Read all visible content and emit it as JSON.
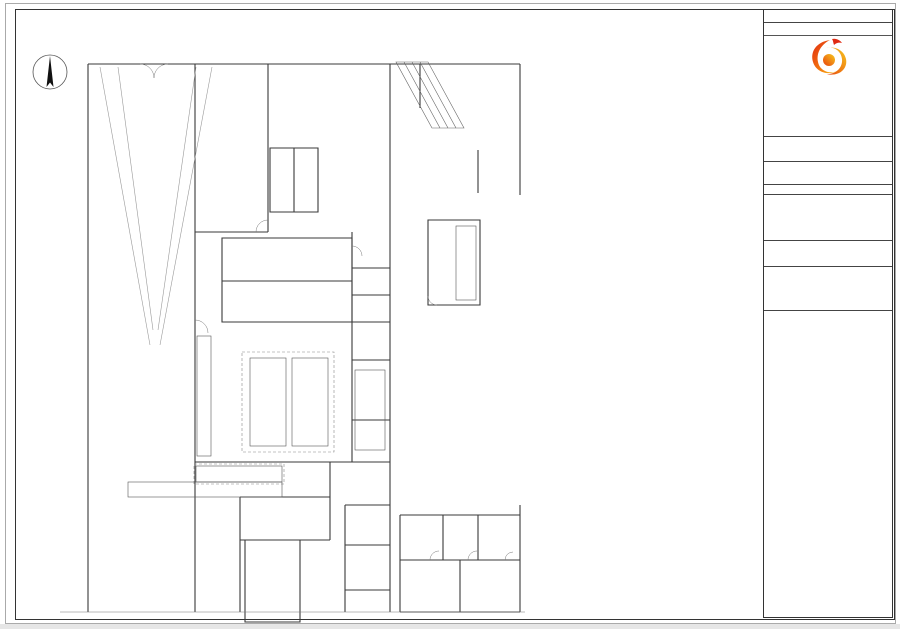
{
  "compass": {
    "label": "北"
  },
  "grid": {
    "top_bubbles": [
      "10-1",
      "10-2",
      "10-3",
      "10-4"
    ],
    "top_bubble_x": [
      98,
      223,
      348,
      470
    ],
    "top_dims": [
      {
        "t": "2300",
        "x": 84
      },
      {
        "t": "7800",
        "x": 160
      },
      {
        "t": "7800",
        "x": 286
      },
      {
        "t": "7500",
        "x": 408
      }
    ],
    "left_dims": [
      {
        "t": "6900",
        "y": 105
      },
      {
        "t": "8400",
        "y": 232
      },
      {
        "t": "9000",
        "y": 390
      },
      {
        "t": "5500",
        "y": 530
      }
    ]
  },
  "plan": {
    "labels": [
      {
        "t": "后勤出入口",
        "x": 147,
        "y": 61,
        "s": 3.5
      },
      {
        "t": "车道上空",
        "x": 161,
        "y": 272,
        "s": 9
      },
      {
        "t": "西厨办公室",
        "x": 231,
        "y": 241,
        "s": 4
      },
      {
        "t": "冷藏库",
        "x": 262,
        "y": 259,
        "s": 4.5
      },
      {
        "t": "冷冻库",
        "x": 262,
        "y": 296,
        "s": 4.5
      },
      {
        "t": "西餐厨房",
        "x": 261,
        "y": 343,
        "s": 4.5
      },
      {
        "t": "餐饮办公室",
        "x": 371,
        "y": 252,
        "s": 3.2
      },
      {
        "t": "酒水库",
        "x": 369,
        "y": 287,
        "s": 3.2
      },
      {
        "t": "调料库",
        "x": 369,
        "y": 316,
        "s": 3.2
      },
      {
        "t": "备餐间",
        "x": 369,
        "y": 392,
        "s": 3.2
      },
      {
        "t": "大堂吧",
        "x": 509,
        "y": 182,
        "s": 7.5
      },
      {
        "t": "大堂吧制作间",
        "x": 447,
        "y": 279,
        "s": 3
      },
      {
        "t": "大堂",
        "x": 506,
        "y": 313,
        "s": 8
      },
      {
        "t": "吧台",
        "x": 213,
        "y": 459,
        "s": 3.2
      },
      {
        "t": "全日制餐厅",
        "x": 128,
        "y": 578,
        "s": 5.5
      },
      {
        "t": "自助餐台",
        "x": 204,
        "y": 588,
        "s": 3.5
      },
      {
        "t": "水井",
        "x": 366,
        "y": 530,
        "s": 3
      },
      {
        "t": "强电间",
        "x": 361,
        "y": 568,
        "s": 3
      },
      {
        "t": "弱电间",
        "x": 361,
        "y": 610,
        "s": 3
      },
      {
        "t": "保洁间",
        "x": 420,
        "y": 588,
        "s": 3
      },
      {
        "t": "女卫生间1",
        "x": 409,
        "y": 535,
        "s": 3
      },
      {
        "t": "女卫生间2",
        "x": 453,
        "y": 535,
        "s": 3
      },
      {
        "t": "女卫生间3",
        "x": 495,
        "y": 535,
        "s": 3
      },
      {
        "t": "无障碍卫生间",
        "x": 504,
        "y": 578,
        "s": 2.8
      },
      {
        "t": "男卫生间",
        "x": 474,
        "y": 602,
        "s": 3
      }
    ]
  },
  "tables": {
    "headers": [
      "序号",
      "名称",
      "规格型号",
      "数量",
      "单位"
    ],
    "left_rows": [
      {
        "s": "冷藏、冷冻库"
      },
      {
        "n": "BA01",
        "m": "四层货架",
        "g": "1200×600×1800",
        "q": "12",
        "u": "台"
      },
      {
        "n": "BA02a",
        "m": "冷冻库体",
        "g": "2500×2500×2500",
        "q": "60",
        "u": "m³"
      },
      {
        "n": "BA02b",
        "m": "冷冻库门",
        "g": "",
        "q": "1",
        "u": "个"
      },
      {
        "n": "BA02c",
        "m": "冷冻制冷机组",
        "g": "",
        "q": "1",
        "u": "组"
      },
      {
        "n": "BA02d",
        "m": "室内冷风机",
        "g": "",
        "q": "1",
        "u": "台"
      },
      {
        "n": "BA03a",
        "m": "冷藏库体",
        "g": "2500×2300×2500",
        "q": "61.5",
        "u": "m³"
      },
      {
        "n": "BA03b",
        "m": "冷藏库门",
        "g": "",
        "q": "1",
        "u": "个"
      },
      {
        "n": "BA03c",
        "m": "冷藏制冷机组",
        "g": "",
        "q": "1",
        "u": "组"
      },
      {
        "n": "BA03d",
        "m": "室内冷风机",
        "g": "",
        "q": "1",
        "u": "台"
      },
      {
        "n": "BA04",
        "m": "四层货架",
        "g": "1500×600×1800",
        "q": "4",
        "u": "台"
      },
      {
        "s": "干货库"
      },
      {
        "n": "BB01",
        "m": "四层货架",
        "g": "1500×600×1800",
        "q": "2",
        "u": "台"
      },
      {
        "n": "BB02",
        "m": "四层货架",
        "g": "1200×600×1800",
        "q": "1",
        "u": "台"
      },
      {
        "s": "蛋糕展示区"
      },
      {
        "n": "BC01",
        "m": "三层蛋糕展示柜",
        "g": "1500×600×1800",
        "q": "1",
        "u": "台"
      },
      {
        "s": "酒水库"
      },
      {
        "n": "BE01",
        "m": "四层货架",
        "g": "1500×600×1800",
        "q": "2",
        "u": "台"
      },
      {
        "n": "BE02",
        "m": "四层货架",
        "g": "1200×600×1800",
        "q": "1",
        "u": "台"
      },
      {
        "s": "粗加工间、冷菜间"
      },
      {
        "n": "BF01",
        "m": "洗手池",
        "g": "500×500×800",
        "q": "1",
        "u": "台"
      },
      {
        "n": "BF01a",
        "m": "感应水龙头",
        "g": "",
        "q": "1",
        "u": "个"
      },
      {
        "n": "BF02",
        "m": "碗柜",
        "g": "1200×600×1800",
        "q": "1",
        "u": "台"
      },
      {
        "n": "BF03",
        "m": "双星洗池",
        "g": "1200×700×800",
        "q": "1",
        "u": "台"
      },
      {
        "n": "BF03a",
        "m": "泡水龙头",
        "g": "",
        "q": "2",
        "u": "个"
      },
      {
        "n": "BF03b",
        "m": "隔渣笼",
        "g": "300×300×300",
        "q": "1",
        "u": "个"
      },
      {
        "n": "BF03c",
        "m": "挂墙单层架",
        "g": "1200×300",
        "q": "1",
        "u": "台"
      },
      {
        "n": "BF04",
        "m": "四门高身雪柜",
        "g": "1220×760×1955",
        "q": "1",
        "u": "台"
      },
      {
        "n": "BF05",
        "m": "单星解冻池",
        "g": "1800×750×800",
        "q": "1",
        "u": "台"
      },
      {
        "n": "BF06",
        "m": "落地层架",
        "g": "1800×750×400",
        "q": "3",
        "u": "台"
      },
      {
        "n": "BF07",
        "m": "双门平台雪柜",
        "g": "1800×750×800",
        "q": "1",
        "u": "台"
      },
      {
        "n": "BF08",
        "m": "单层调理架",
        "g": "1100×750×800",
        "q": "1",
        "u": "台"
      },
      {
        "n": "BF09",
        "m": "两头矮汤炉",
        "g": "",
        "q": "1",
        "u": "台"
      },
      {
        "s": "洗碗间"
      },
      {
        "n": "BG01",
        "m": "碗架",
        "g": "1200×500×1800",
        "q": "3",
        "u": "台"
      },
      {
        "n": "BG02",
        "m": "双层工作台",
        "g": "1800×760×800",
        "q": "1",
        "u": "台"
      },
      {
        "n": "BG03",
        "m": "高温消毒柜",
        "g": "",
        "q": "1",
        "u": "台"
      },
      {
        "n": "BG04",
        "m": "洁碟台",
        "g": "1500×760×800",
        "q": "1",
        "u": "台"
      },
      {
        "n": "BG05",
        "m": "排气罩",
        "g": "1600×1000",
        "q": "1.1",
        "u": "㎡"
      },
      {
        "n": "BG06",
        "m": "洗碗机",
        "g": "",
        "q": "1",
        "u": "台"
      },
      {
        "n": "BG06a",
        "m": "洗碗机用软水机",
        "g": "",
        "q": "1",
        "u": "台"
      },
      {
        "n": "BG07",
        "m": "水压花洒",
        "g": "",
        "q": "1",
        "u": "台"
      },
      {
        "n": "BG08",
        "m": "双星污碟台",
        "g": "1800×750×800",
        "q": "1",
        "u": "台"
      },
      {
        "n": "BG08a",
        "m": "隔渣笼",
        "g": "300×300×300",
        "q": "1",
        "u": "个"
      },
      {
        "n": "BG08b",
        "m": "泡水龙头",
        "g": "",
        "q": "1",
        "u": "个"
      },
      {
        "n": "BG09",
        "m": "残食台",
        "g": "1200×750×800",
        "q": "1",
        "u": "台"
      },
      {
        "n": "BG10",
        "m": "洗碗龙头",
        "g": "",
        "q": "1",
        "u": "台"
      },
      {
        "s": "备餐间"
      },
      {
        "n": "BH01",
        "m": "制冰机",
        "g": "300KG",
        "q": "1",
        "u": "台"
      },
      {
        "n": "BH01a",
        "m": "制冰机用滤水器",
        "g": "",
        "q": "1",
        "u": "台"
      },
      {
        "n": "BH02",
        "m": "制冰机",
        "g": "100KG",
        "q": "1",
        "u": "台"
      },
      {
        "n": "BH02a",
        "m": "制冰机用滤水器",
        "g": "",
        "q": "1",
        "u": "台"
      },
      {
        "n": "BH03",
        "m": "单星盆台连双层吊架",
        "g": "1500×750×800",
        "q": "1",
        "u": "台"
      },
      {
        "n": "BH03a",
        "m": "泡水龙头",
        "g": "",
        "q": "1",
        "u": "个"
      },
      {
        "n": "BH03b",
        "m": "隔渣笼",
        "g": "300×300×300",
        "q": "1",
        "u": "个"
      },
      {
        "n": "BH04",
        "m": "台式开水器",
        "g": "9KW",
        "q": "1",
        "u": "台"
      },
      {
        "n": "BH04a",
        "m": "开水器用滤水器",
        "g": "",
        "q": "1",
        "u": "台"
      },
      {
        "n": "BH05",
        "m": "单层调理架",
        "g": "1800×750×800",
        "q": "1",
        "u": "台"
      },
      {
        "n": "BH06",
        "m": "落地层架",
        "g": "1800×350×400",
        "q": "1",
        "u": "台"
      },
      {
        "s": "西餐厨房"
      },
      {
        "n": "BI01",
        "m": "四层货架",
        "g": "900×760×1800",
        "q": "1",
        "u": "台"
      },
      {
        "n": "BI02",
        "m": "四门高身雪柜",
        "g": "1220×760×1955",
        "q": "2",
        "u": "台"
      },
      {
        "n": "BI03",
        "m": "单星盆台",
        "g": "600×760×800",
        "q": "2",
        "u": "台"
      },
      {
        "n": "BI03a",
        "m": "泡水龙头",
        "g": "",
        "q": "2",
        "u": "个"
      },
      {
        "n": "BI03b",
        "m": "隔渣笼",
        "g": "300×300×300",
        "q": "2",
        "u": "个"
      },
      {
        "n": "BI04",
        "m": "双门平台雪柜",
        "g": "1800×750×800",
        "q": "1",
        "u": "台"
      },
      {
        "n": "BI04a",
        "m": "底置制冷机组",
        "g": "",
        "q": "4",
        "u": "台"
      }
    ],
    "right_rows": [
      {
        "n": "BI05",
        "m": "双门恒温平台雪柜",
        "g": "1800×750×800",
        "q": "2",
        "u": "台"
      },
      {
        "n": "BI06",
        "m": "洗地龙头",
        "g": "",
        "q": "1",
        "u": "台"
      },
      {
        "n": "BI07",
        "m": "四层烤盘架",
        "g": "1500×750×800",
        "q": "1",
        "u": "台"
      },
      {
        "n": "BI08",
        "m": "柜式运水烟罩机",
        "g": "1800×750×800",
        "q": "1",
        "u": "台"
      },
      {
        "n": "BI09",
        "m": "双层工作台",
        "g": "",
        "q": "1",
        "u": "台"
      },
      {
        "n": "BI10",
        "m": "燃气平头炉连底柜",
        "g": "700×775×850",
        "q": "1",
        "u": "台"
      },
      {
        "n": "BI11",
        "m": "吊柜",
        "g": "定制",
        "q": "2",
        "u": "台"
      },
      {
        "n": "BI12",
        "m": "电磁大炉",
        "g": "",
        "q": "1",
        "u": "台"
      },
      {
        "n": "BI13",
        "m": "单层调理架",
        "g": "2500×750×800",
        "q": "1",
        "u": "台"
      },
      {
        "n": "BI14",
        "m": "双缸电炸炉",
        "g": "700×775×850",
        "q": "1",
        "u": "台"
      },
      {
        "n": "BI15",
        "m": "吊柜",
        "g": "600×750×600",
        "q": "1",
        "u": "台"
      },
      {
        "n": "BI16",
        "m": "单头矮汤炉",
        "g": "600×775×850",
        "q": "1",
        "u": "台"
      },
      {
        "n": "BI17",
        "m": "吊柜",
        "g": "600×750×600",
        "q": "1",
        "u": "台"
      },
      {
        "n": "BI18",
        "m": "燃气扒炉连柜",
        "g": "700×775×850",
        "q": "1",
        "u": "台"
      },
      {
        "n": "BI19",
        "m": "单星水池",
        "g": "600×750×800",
        "q": "1",
        "u": "台"
      },
      {
        "n": "BI19a",
        "m": "泡水龙头",
        "g": "",
        "q": "1",
        "u": "个"
      },
      {
        "n": "BI19b",
        "m": "隔渣笼",
        "g": "300×300×300",
        "q": "1",
        "u": "个"
      },
      {
        "n": "BI20",
        "m": "燃气六头煲仔炉连柜",
        "g": "1000×775×850",
        "q": "1",
        "u": "台"
      },
      {
        "n": "BI21",
        "m": "万能蒸柜",
        "g": "10盘",
        "q": "1",
        "u": "台"
      },
      {
        "n": "BI21a",
        "m": "万能蒸柜用软水机",
        "g": "",
        "q": "1",
        "u": "台"
      },
      {
        "n": "BI22",
        "m": "岛式运水烟罩",
        "g": "4500×1200×600",
        "q": "9.9",
        "u": "平米"
      },
      {
        "n": "BI22a",
        "m": "运水烟罩装饰包板",
        "g": "",
        "q": "13.4",
        "u": "米"
      },
      {
        "n": "BI23",
        "m": "搁板架",
        "g": "1200×600×1800",
        "q": "1",
        "u": "台"
      },
      {
        "n": "BI24",
        "m": "挂墙吊架",
        "g": "2000×310×600",
        "q": "1",
        "u": "台"
      },
      {
        "n": "BI25",
        "m": "燃气火山石烧烤炉",
        "g": "700×775×850",
        "q": "1",
        "u": "台"
      },
      {
        "s": "明档"
      },
      {
        "n": "BJ01",
        "m": "嵌入式电磁炉",
        "g": "",
        "q": "8",
        "u": "台"
      },
      {
        "n": "BJ02",
        "m": "台下平台雪柜",
        "g": "2000×760×800",
        "q": "1",
        "u": "台"
      },
      {
        "n": "BJ03",
        "m": "单星盆台",
        "g": "600×760×800",
        "q": "1",
        "u": "台"
      },
      {
        "n": "BJ03a",
        "m": "泡水龙头",
        "g": "",
        "q": "1",
        "u": "个"
      },
      {
        "n": "BJ03b",
        "m": "隔渣笼",
        "g": "300×300×300",
        "q": "1",
        "u": "个"
      },
      {
        "n": "BJ04",
        "m": "四路保温台",
        "g": "700×760×800",
        "q": "1",
        "u": "台"
      },
      {
        "n": "BJ05",
        "m": "面火炉",
        "g": "700×760×800",
        "q": "2",
        "u": "台"
      },
      {
        "n": "BJ06",
        "m": "双缸电炸炉",
        "g": "700×775×850",
        "q": "1",
        "u": "台"
      },
      {
        "n": "BJ07",
        "m": "叠式电烤炉",
        "g": "700×775×850",
        "q": "1",
        "u": "台"
      },
      {
        "n": "BJ08",
        "m": "运水烟罩",
        "g": "4000×1000×600",
        "q": "4.6",
        "u": "平米"
      },
      {
        "n": "BJ08a",
        "m": "运水烟罩装饰包板",
        "g": "",
        "q": "11.2",
        "u": "米"
      },
      {
        "n": "BJ08b",
        "m": "前端油烟净化器",
        "g": "600×500",
        "q": "1",
        "u": "台"
      },
      {
        "n": "BJ09",
        "m": "煎烤炉连柜",
        "g": "600×775×850",
        "q": "1",
        "u": "台"
      },
      {
        "n": "BJ10",
        "m": "烧烤炉连柜",
        "g": "600×775×850",
        "q": "1",
        "u": "台"
      },
      {
        "s": "大堂吧制作间"
      },
      {
        "n": "BK01",
        "m": "碗架",
        "g": "1200×500×1800",
        "q": "1",
        "u": "台"
      },
      {
        "n": "BK02",
        "m": "两组洋酒架",
        "g": "",
        "q": "1",
        "u": "台"
      },
      {
        "n": "BK03",
        "m": "四门高身雪柜",
        "g": "1220×760×1955",
        "q": "1",
        "u": "台"
      },
      {
        "n": "BK04",
        "m": "双星盆台",
        "g": "1600×750×800",
        "q": "1",
        "u": "台"
      },
      {
        "n": "BK04a",
        "m": "泡水龙头",
        "g": "",
        "q": "2",
        "u": "个"
      },
      {
        "n": "BK04b",
        "m": "隔渣笼",
        "g": "300×300×300",
        "q": "1",
        "u": "个"
      },
      {
        "n": "BK04c",
        "m": "挂墙单层架",
        "g": "2000×300",
        "q": "1",
        "u": "台"
      },
      {
        "n": "BK05",
        "m": "台下式洗杯机",
        "g": "",
        "q": "1",
        "u": "台"
      },
      {
        "n": "BK06",
        "m": "单层工作台",
        "g": "",
        "q": "1",
        "u": "台"
      },
      {
        "n": "BK06a",
        "m": "落地层架",
        "g": "1800×350×800",
        "q": "2",
        "u": "台"
      },
      {
        "n": "BK07",
        "m": "单层调理架",
        "g": "1800×750×800",
        "q": "1",
        "u": "台"
      },
      {
        "s": "吧台"
      },
      {
        "n": "BL01",
        "m": "单星盆台",
        "g": "1500×750×800",
        "q": "1",
        "u": "台"
      },
      {
        "n": "BL01a",
        "m": "泡水龙头",
        "g": "",
        "q": "1",
        "u": "个"
      },
      {
        "n": "BL01b",
        "m": "隔渣笼",
        "g": "500×300×300",
        "q": "1",
        "u": "个"
      },
      {
        "n": "BL02",
        "m": "单星调理柜连酒架",
        "g": "1500×750×800",
        "q": "1",
        "u": "台"
      },
      {
        "n": "BL02a",
        "m": "泡水龙头",
        "g": "",
        "q": "1",
        "u": "个"
      },
      {
        "n": "BL02b",
        "m": "隔渣笼",
        "g": "300×300×300",
        "q": "1",
        "u": "个"
      },
      {
        "n": "BL03",
        "m": "台下式制冰机",
        "g": "50KG",
        "q": "1",
        "u": "台"
      },
      {
        "n": "BL03a",
        "m": "制冰机用滤水器",
        "g": "",
        "q": "1",
        "u": "台"
      },
      {
        "n": "BL04",
        "m": "榨橙汁机",
        "g": "",
        "q": "1",
        "u": "台"
      },
      {
        "n": "BL05",
        "m": "咖啡机",
        "g": "",
        "q": "1",
        "u": "台"
      },
      {
        "n": "BL06",
        "m": "奶昔搅拌机",
        "g": "",
        "q": "1",
        "u": "台"
      },
      {
        "n": "BL07",
        "m": "单层调理架",
        "g": "1800×750×800",
        "q": "1",
        "u": "台"
      }
    ]
  },
  "titleblock": {
    "sign_title": "会签栏",
    "sign_rows": [
      [
        "总图",
        "给水排水"
      ],
      [
        "建筑",
        "电气"
      ],
      [
        "结构",
        "动力"
      ],
      [
        "暖通空调",
        ""
      ]
    ],
    "rev_headers": [
      "版本",
      "修改内容",
      "修改日期"
    ],
    "design_label": "设计单位:",
    "company_cn": "北京奇能商厨设计顾问有限公司",
    "company_en": "Beijing Qineng Shangchu Design Consultants Co.,Ltd",
    "email": "E-mail:bjqnsc@163.com",
    "website": "网址：www.bjqnsc.com",
    "build_label": "建设单位:",
    "project_label": "工程名称:",
    "project_name": "北京泰富酒店",
    "project_no_label": "工程编号",
    "approvals": [
      [
        "审  定",
        "工程负责人"
      ],
      [
        "审  核",
        "设  计"
      ],
      [
        "校  对",
        "绘  图"
      ],
      [
        "专业负责人",
        "日  期"
      ]
    ],
    "drawing_label": "图纸名称:",
    "drawing_title1": "一层西餐厅厨房",
    "drawing_title2": "厨房设备平面布置图",
    "meta": [
      [
        "专业",
        "厨房设备",
        "图号",
        "A2"
      ],
      [
        "单位",
        "mm",
        "比例",
        "1:100"
      ]
    ],
    "seal_label": "出图签章",
    "disclaimer": "※ 全部设计图纸及说明之版权属于本公司，未得本公司书面同意，不得使用、抄袭及复制。所有尺寸均以mm为单位，须以实地核对，不能以度量图中尺寸为准。",
    "note": "本图须加盖本公司出图签章，否则一律无效"
  },
  "watermark": {
    "fragments": [
      {
        "t": "奇能",
        "x": 70,
        "y": 355,
        "s": 115
      },
      {
        "t": "400—",
        "x": 350,
        "y": 262,
        "s": 85
      },
      {
        "t": "36",
        "x": 565,
        "y": 112,
        "s": 85
      }
    ]
  }
}
